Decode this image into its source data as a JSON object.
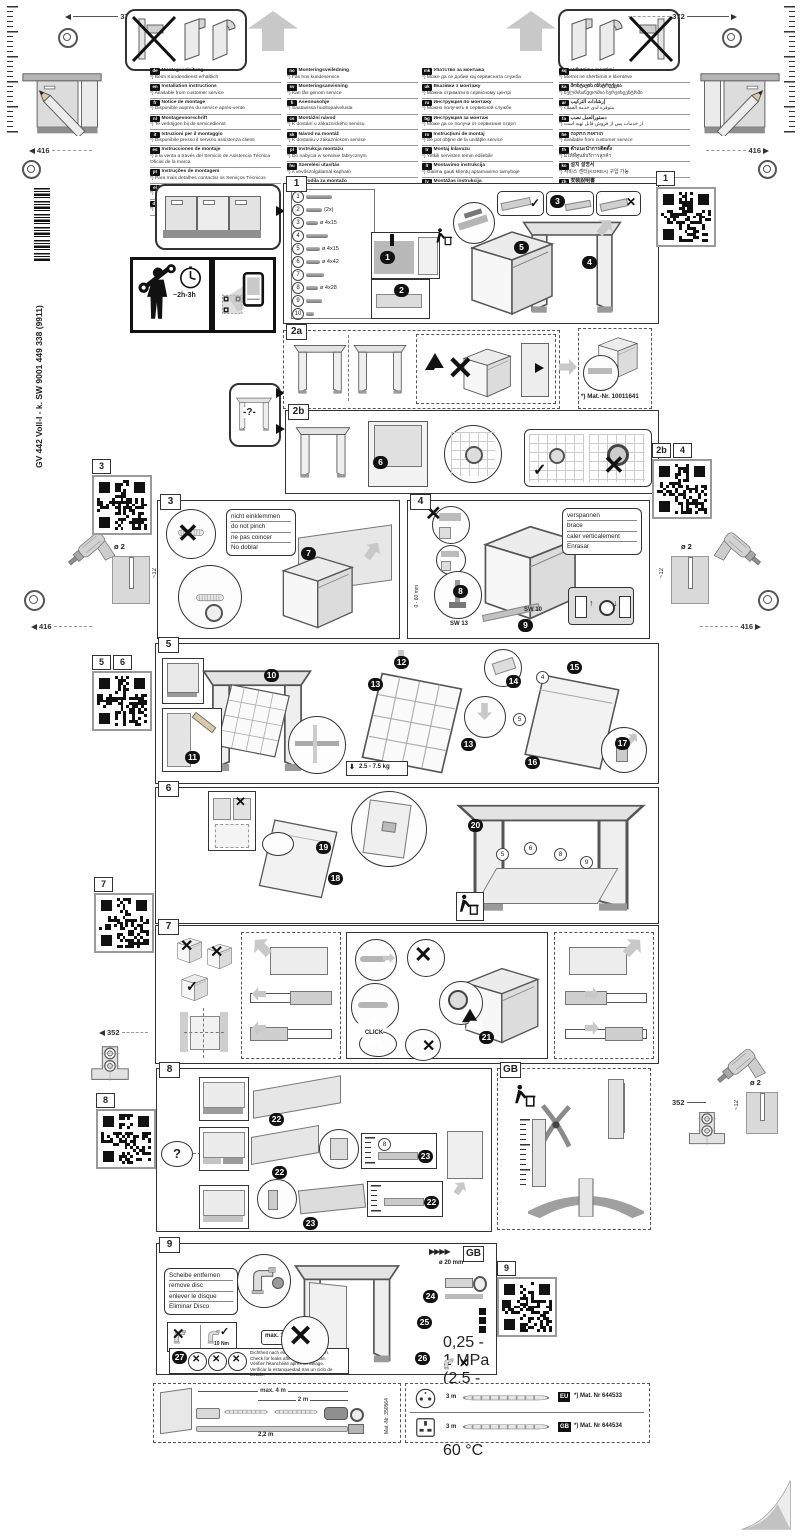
{
  "header": {
    "dim_372": "372",
    "dim_416": "416"
  },
  "product_code": "GV 442 Voll-I - k. SW  9001 449 338 (9911)",
  "time_estimate": "~2h-3h",
  "question_mark": "-?-",
  "drill": {
    "dia": "ø 2",
    "depth": "~12",
    "dim_352": "352"
  },
  "icons": {
    "check": "✓",
    "cross": "✕",
    "warn": "!",
    "fwd": "▶▶▶▶"
  },
  "languages": {
    "col1": [
      {
        "code": "de",
        "label": "Montageanleitung",
        "note": "*) Beim Kundendienst erhältlich"
      },
      {
        "code": "en",
        "label": "Installation instructions",
        "note": "*) Available from customer service"
      },
      {
        "code": "fr",
        "label": "Notice de montage",
        "note": "*) Disponible auprès du service après-vente"
      },
      {
        "code": "nl",
        "label": "Montagevoorschrift",
        "note": "*) Te verkrijgen bij de servicedienst"
      },
      {
        "code": "it",
        "label": "Istruzioni per il montaggio",
        "note": "*) Disponibile presso il servizio assistenza clienti"
      },
      {
        "code": "es",
        "label": "Instrucciones de montaje",
        "note": "*) a la venta a través del Servicio de Asistencia Técnica Oficial de la marca"
      },
      {
        "code": "pt",
        "label": "Instruções de montagem",
        "note": "*) Para mais detalhes contactar os Serviços Técnicos"
      },
      {
        "code": "el",
        "label": "Οδηγίες τοποθέτησης",
        "note": "*) Διατίθενται από την υπηρεσία εξυπηρέτησης πελατών"
      },
      {
        "code": "da",
        "label": "Monteringsvejledning",
        "note": "*) Kan fås via service"
      }
    ],
    "col2": [
      {
        "code": "no",
        "label": "Monteringsveiledning",
        "note": "*) Fås hos kundeservice"
      },
      {
        "code": "sv",
        "label": "Monteringsanvisning",
        "note": "*) Kan fås genom service"
      },
      {
        "code": "fi",
        "label": "Asennusohje",
        "note": "*) Saatavissa huoltopalvelusta"
      },
      {
        "code": "cs",
        "label": "Montážní návod",
        "note": "*) K dostání u zákaznického servisu"
      },
      {
        "code": "sk",
        "label": "Návod na montáž",
        "note": "*) K dostaniu v zákazníckom servise"
      },
      {
        "code": "pl",
        "label": "Instrukcja montażu",
        "note": "*) Do nabycia w serwisie fabrycznym"
      },
      {
        "code": "hu",
        "label": "Szerelési utasítás",
        "note": "*) A vevőszolgálatnál kapható"
      },
      {
        "code": "sl",
        "label": "Navodila za montažo",
        "note": "*) Na voljo pri servisni službi"
      },
      {
        "code": "hr",
        "label": "Upute za montažu",
        "note": "*) Može se dobiti kod servisne službe"
      },
      {
        "code": "sr",
        "label": "Uputstvo za montažu",
        "note": "*) Može se nabaviti preko servisne službe"
      }
    ],
    "col3": [
      {
        "code": "mk",
        "label": "Упатство за монтажа",
        "note": "*) Може да се добие кај сервисната служба"
      },
      {
        "code": "uk",
        "label": "Вказівки з монтажу",
        "note": "*) Можна отримати в сервісному центрі"
      },
      {
        "code": "ru",
        "label": "Инструкция по монтажу",
        "note": "*) Можно получить в сервисной службе"
      },
      {
        "code": "bg",
        "label": "Инструкция за монтаж",
        "note": "*) Може да се получи от сервизния отдел"
      },
      {
        "code": "ro",
        "label": "Instrucţiuni de montaj",
        "note": "*) Se pot obţine de la unităţile service"
      },
      {
        "code": "tr",
        "label": "Montaj kılavuzu",
        "note": "*) Yetkili servisten temin edilebilir"
      },
      {
        "code": "lt",
        "label": "Montavimo instrukcija",
        "note": "*) Galima gauti klientų aptarnavimo tarnyboje"
      },
      {
        "code": "lv",
        "label": "Montāžas instrukcija",
        "note": "*) Pieejama klientu servisā"
      },
      {
        "code": "et",
        "label": "Paigaldusjuhend",
        "note": "*) Saadaval klienditeenindusest"
      },
      {
        "code": "kk",
        "label": "Құрастыру нұсқаулығы",
        "note": "*) Сервис қызметінен алуға болады"
      }
    ],
    "col4": [
      {
        "code": "sq",
        "label": "Udhëzime montimi",
        "note": "*) Merret në shërbimin e klientëve"
      },
      {
        "code": "ka",
        "label": "მონტაჟის ინსტრუქცია",
        "note": "*) ხელმისაწვდომია სერვისცენტრში"
      },
      {
        "code": "ar",
        "label": "إرشادات التركيب",
        "note": "*) متوفرة لدى خدمة العملاء"
      },
      {
        "code": "fa",
        "label": "دستورالعمل نصب",
        "note": "*) از خدمات پس از فروش قابل تهیه است"
      },
      {
        "code": "he",
        "label": "הוראות התקנה",
        "note": "*) available from customer service"
      },
      {
        "code": "th",
        "label": "คำแนะนำการติดตั้ง",
        "note": "*) มีให้ที่ศูนย์บริการลูกค้า"
      },
      {
        "code": "ko",
        "label": "설치 설명서",
        "note": "*) 서비스 센터(KOREA) 구입 가능"
      },
      {
        "code": "zh",
        "label": "安裝說明書",
        "note": "*) 可向客戶服務部門索取"
      },
      {
        "code": "zh",
        "label": "安装说明书",
        "note": "*) 可向售后服务部门索取"
      }
    ]
  },
  "steps": {
    "s1": {
      "label": "1",
      "parts": [
        {
          "num": "1",
          "spec": ""
        },
        {
          "num": "2",
          "spec": "(2x)"
        },
        {
          "num": "3",
          "spec": "ø 4x15"
        },
        {
          "num": "4",
          "spec": ""
        },
        {
          "num": "5",
          "spec": "ø 4x15"
        },
        {
          "num": "6",
          "spec": "ø 4x42"
        },
        {
          "num": "7",
          "spec": ""
        },
        {
          "num": "8",
          "spec": "ø 4x28"
        },
        {
          "num": "9",
          "spec": ""
        },
        {
          "num": "10",
          "spec": ""
        }
      ],
      "badges": [
        "1",
        "2",
        "3",
        "4",
        "5"
      ]
    },
    "s2a": {
      "label": "2a",
      "mat_nr": "*) Mat.-Nr. 10011641"
    },
    "s2b": {
      "label": "2b",
      "badge": "6"
    },
    "s3": {
      "label": "3",
      "badge": "7",
      "note": [
        "nicht einklemmen",
        "do not pinch",
        "ne pas coincer",
        "No doblar"
      ]
    },
    "s4": {
      "label": "4",
      "badges": [
        "8",
        "9"
      ],
      "note": [
        "verspannen",
        "brace",
        "caler verticalement",
        "Enrasar"
      ],
      "range": "0 - 60 mm",
      "sw13": "SW 13",
      "sw10": "SW 10"
    },
    "s5": {
      "label": "5",
      "badges": [
        "10",
        "11",
        "12",
        "13",
        "13",
        "14",
        "15",
        "16",
        "17"
      ],
      "refs": [
        "4",
        "5"
      ],
      "weight": "2.5 - 7.5 kg"
    },
    "s6": {
      "label": "6",
      "badges": [
        "18",
        "19",
        "20"
      ],
      "refs": [
        "5",
        "6",
        "8",
        "9"
      ]
    },
    "s7": {
      "label": "7",
      "badge": "21",
      "click": "CLICK"
    },
    "s8": {
      "label": "8",
      "q": "?",
      "badges": [
        "22",
        "22",
        "23",
        "23",
        "22"
      ],
      "ref": "8"
    },
    "gb": {
      "label": "GB"
    },
    "s9": {
      "label": "9",
      "note": [
        "Scheibe entfernen",
        "remove disc",
        "enlever le disque",
        "Eliminar Disco"
      ],
      "torque_ok": "10 Nm",
      "torque_max": "max. 10 Nm",
      "hose_dia": "ø 20 mm",
      "pressure": [
        "0,25 - 1 MPa",
        "(2,5 - 10 bar)",
        "max. 60 °C"
      ],
      "badges": [
        "24",
        "25",
        "26",
        "27"
      ],
      "leak_note": [
        "Dichtheit nach einem Spülgang prüfen.",
        "Check for leaks after one wash cycle.",
        "Vérifier l'étanchéité après un lavage.",
        "Verificar la estanqueidad tras un ciclo de lavado."
      ]
    }
  },
  "qr_labels": {
    "q1": "1",
    "q2b": "2b",
    "q3": "3",
    "q4": "4",
    "q5": "5",
    "q6": "6",
    "q7": "7",
    "q8": "8",
    "q9": "9"
  },
  "footer": {
    "drain": {
      "len_max": "max. 4 m",
      "len_mid": "2 m",
      "len_low": "2,2 m",
      "mat_nr": "Mat.-Nr. 350564"
    },
    "power": [
      {
        "plug": "EU",
        "length": "3 m",
        "badge": "EU",
        "mat_nr": "*) Mat. Nr 644533"
      },
      {
        "plug": "GB",
        "length": "3 m",
        "badge": "GB",
        "mat_nr": "*) Mat. Nr 644534"
      }
    ]
  }
}
